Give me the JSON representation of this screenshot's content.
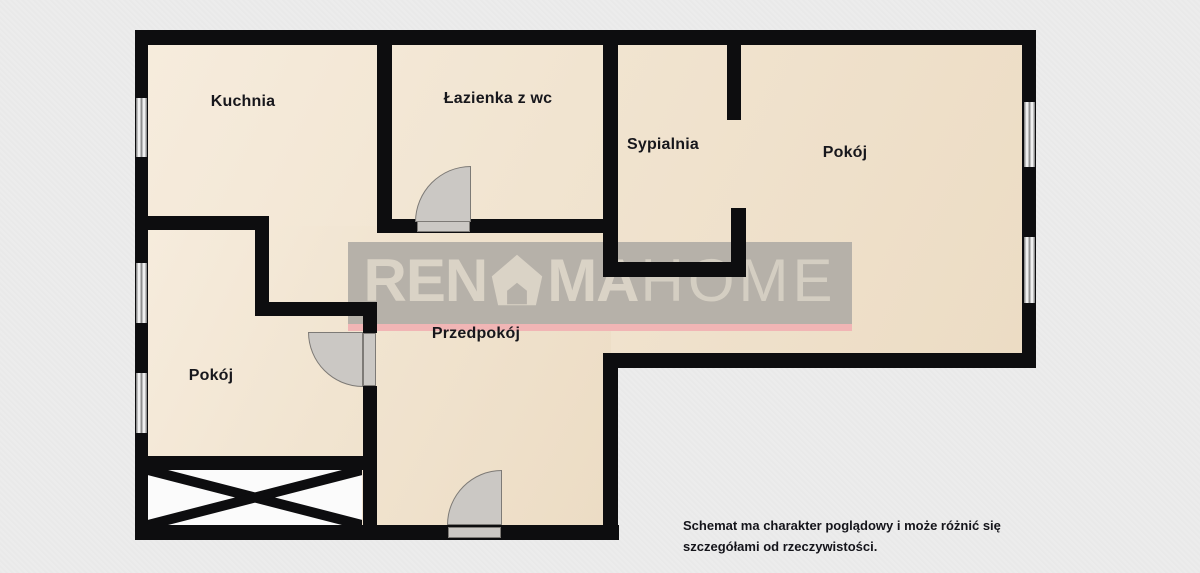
{
  "rooms": [
    {
      "name": "Kuchnia"
    },
    {
      "name": "Łazienka z wc"
    },
    {
      "name": "Sypialnia"
    },
    {
      "name": "Pokój"
    },
    {
      "name": "Pokój"
    },
    {
      "name": "Przedpokój"
    }
  ],
  "watermark": {
    "brand_part1": "REN",
    "brand_part2": "MA",
    "brand_part3": "HOME",
    "accent_color": "#f1b5b5"
  },
  "disclaimer": {
    "line1": "Schemat ma charakter poglądowy i może różnić się",
    "line2": "szczegółami od rzeczywistości."
  },
  "colors": {
    "background": "#ececec",
    "floor": "#f1e4d0",
    "wall": "#0d0d0f",
    "door": "#cbc8c4",
    "window": "#efefef",
    "watermark_bar": "#b6b1a9",
    "watermark_text": "#dad3c6",
    "watermark_accent": "#f1b5b5",
    "label_text": "#17171c"
  }
}
